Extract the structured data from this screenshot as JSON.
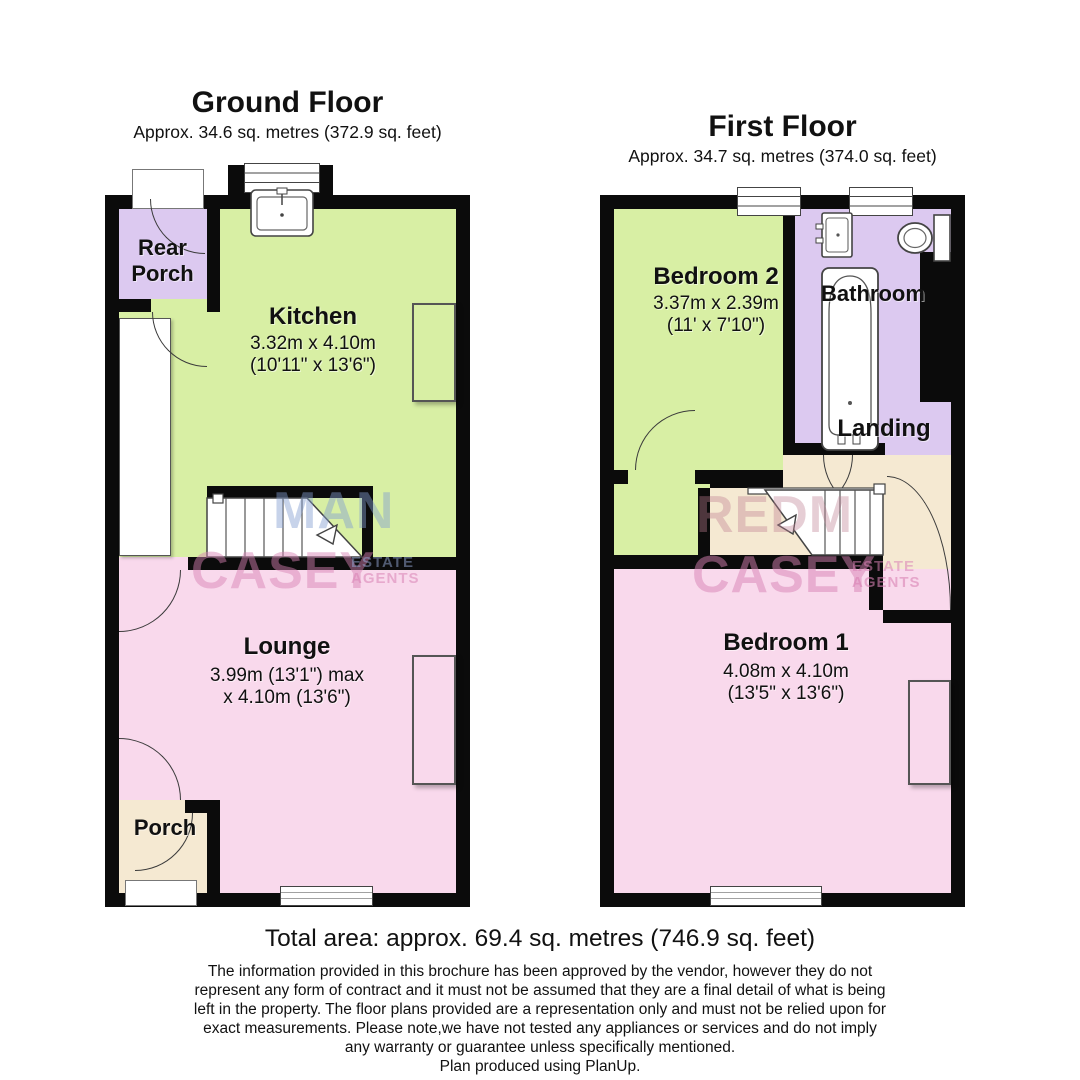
{
  "ground_floor": {
    "title": "Ground Floor",
    "area": "Approx. 34.6 sq. metres (372.9 sq. feet)",
    "rooms": {
      "rear_porch": {
        "name": "Rear Porch"
      },
      "kitchen": {
        "name": "Kitchen",
        "dims1": "3.32m x 4.10m",
        "dims2": "(10'11\" x 13'6\")"
      },
      "lounge": {
        "name": "Lounge",
        "dims1": "3.99m (13'1\") max",
        "dims2": "x 4.10m (13'6\")"
      },
      "porch": {
        "name": "Porch"
      }
    }
  },
  "first_floor": {
    "title": "First Floor",
    "area": "Approx. 34.7 sq. metres (374.0 sq. feet)",
    "rooms": {
      "bedroom2": {
        "name": "Bedroom 2",
        "dims1": "3.37m x 2.39m",
        "dims2": "(11' x 7'10\")"
      },
      "bathroom": {
        "name": "Bathroom"
      },
      "landing": {
        "name": "Landing"
      },
      "bedroom1": {
        "name": "Bedroom 1",
        "dims1": "4.08m x 4.10m",
        "dims2": "(13'5\" x 13'6\")"
      }
    }
  },
  "watermark": {
    "ground_line1": "MAN",
    "ground_line2": "CASEY",
    "first_line1": "REDM",
    "first_line2": "CASEY",
    "sub_line1": "ESTATE",
    "sub_line2": "AGENTS"
  },
  "footer": {
    "total_area": "Total area: approx. 69.4 sq. metres (746.9 sq. feet)",
    "disclaimer_lines": [
      "The information provided in this brochure has been approved by the vendor, however they do not",
      "represent any form of contract and it must not be assumed that they are a final detail of what is being",
      "left in the property. The floor plans provided are a representation only and must not be relied upon for",
      "exact measurements. Please note,we have not tested any appliances or services and do not imply",
      "any warranty or guarantee unless specifically mentioned."
    ],
    "credit": "Plan produced using PlanUp."
  },
  "colors": {
    "room_green": "#d8efa4",
    "room_pink": "#f9d9ec",
    "room_purple": "#dcc9f0",
    "room_beige": "#f5e9d2",
    "wall": "#0b0b0b"
  }
}
